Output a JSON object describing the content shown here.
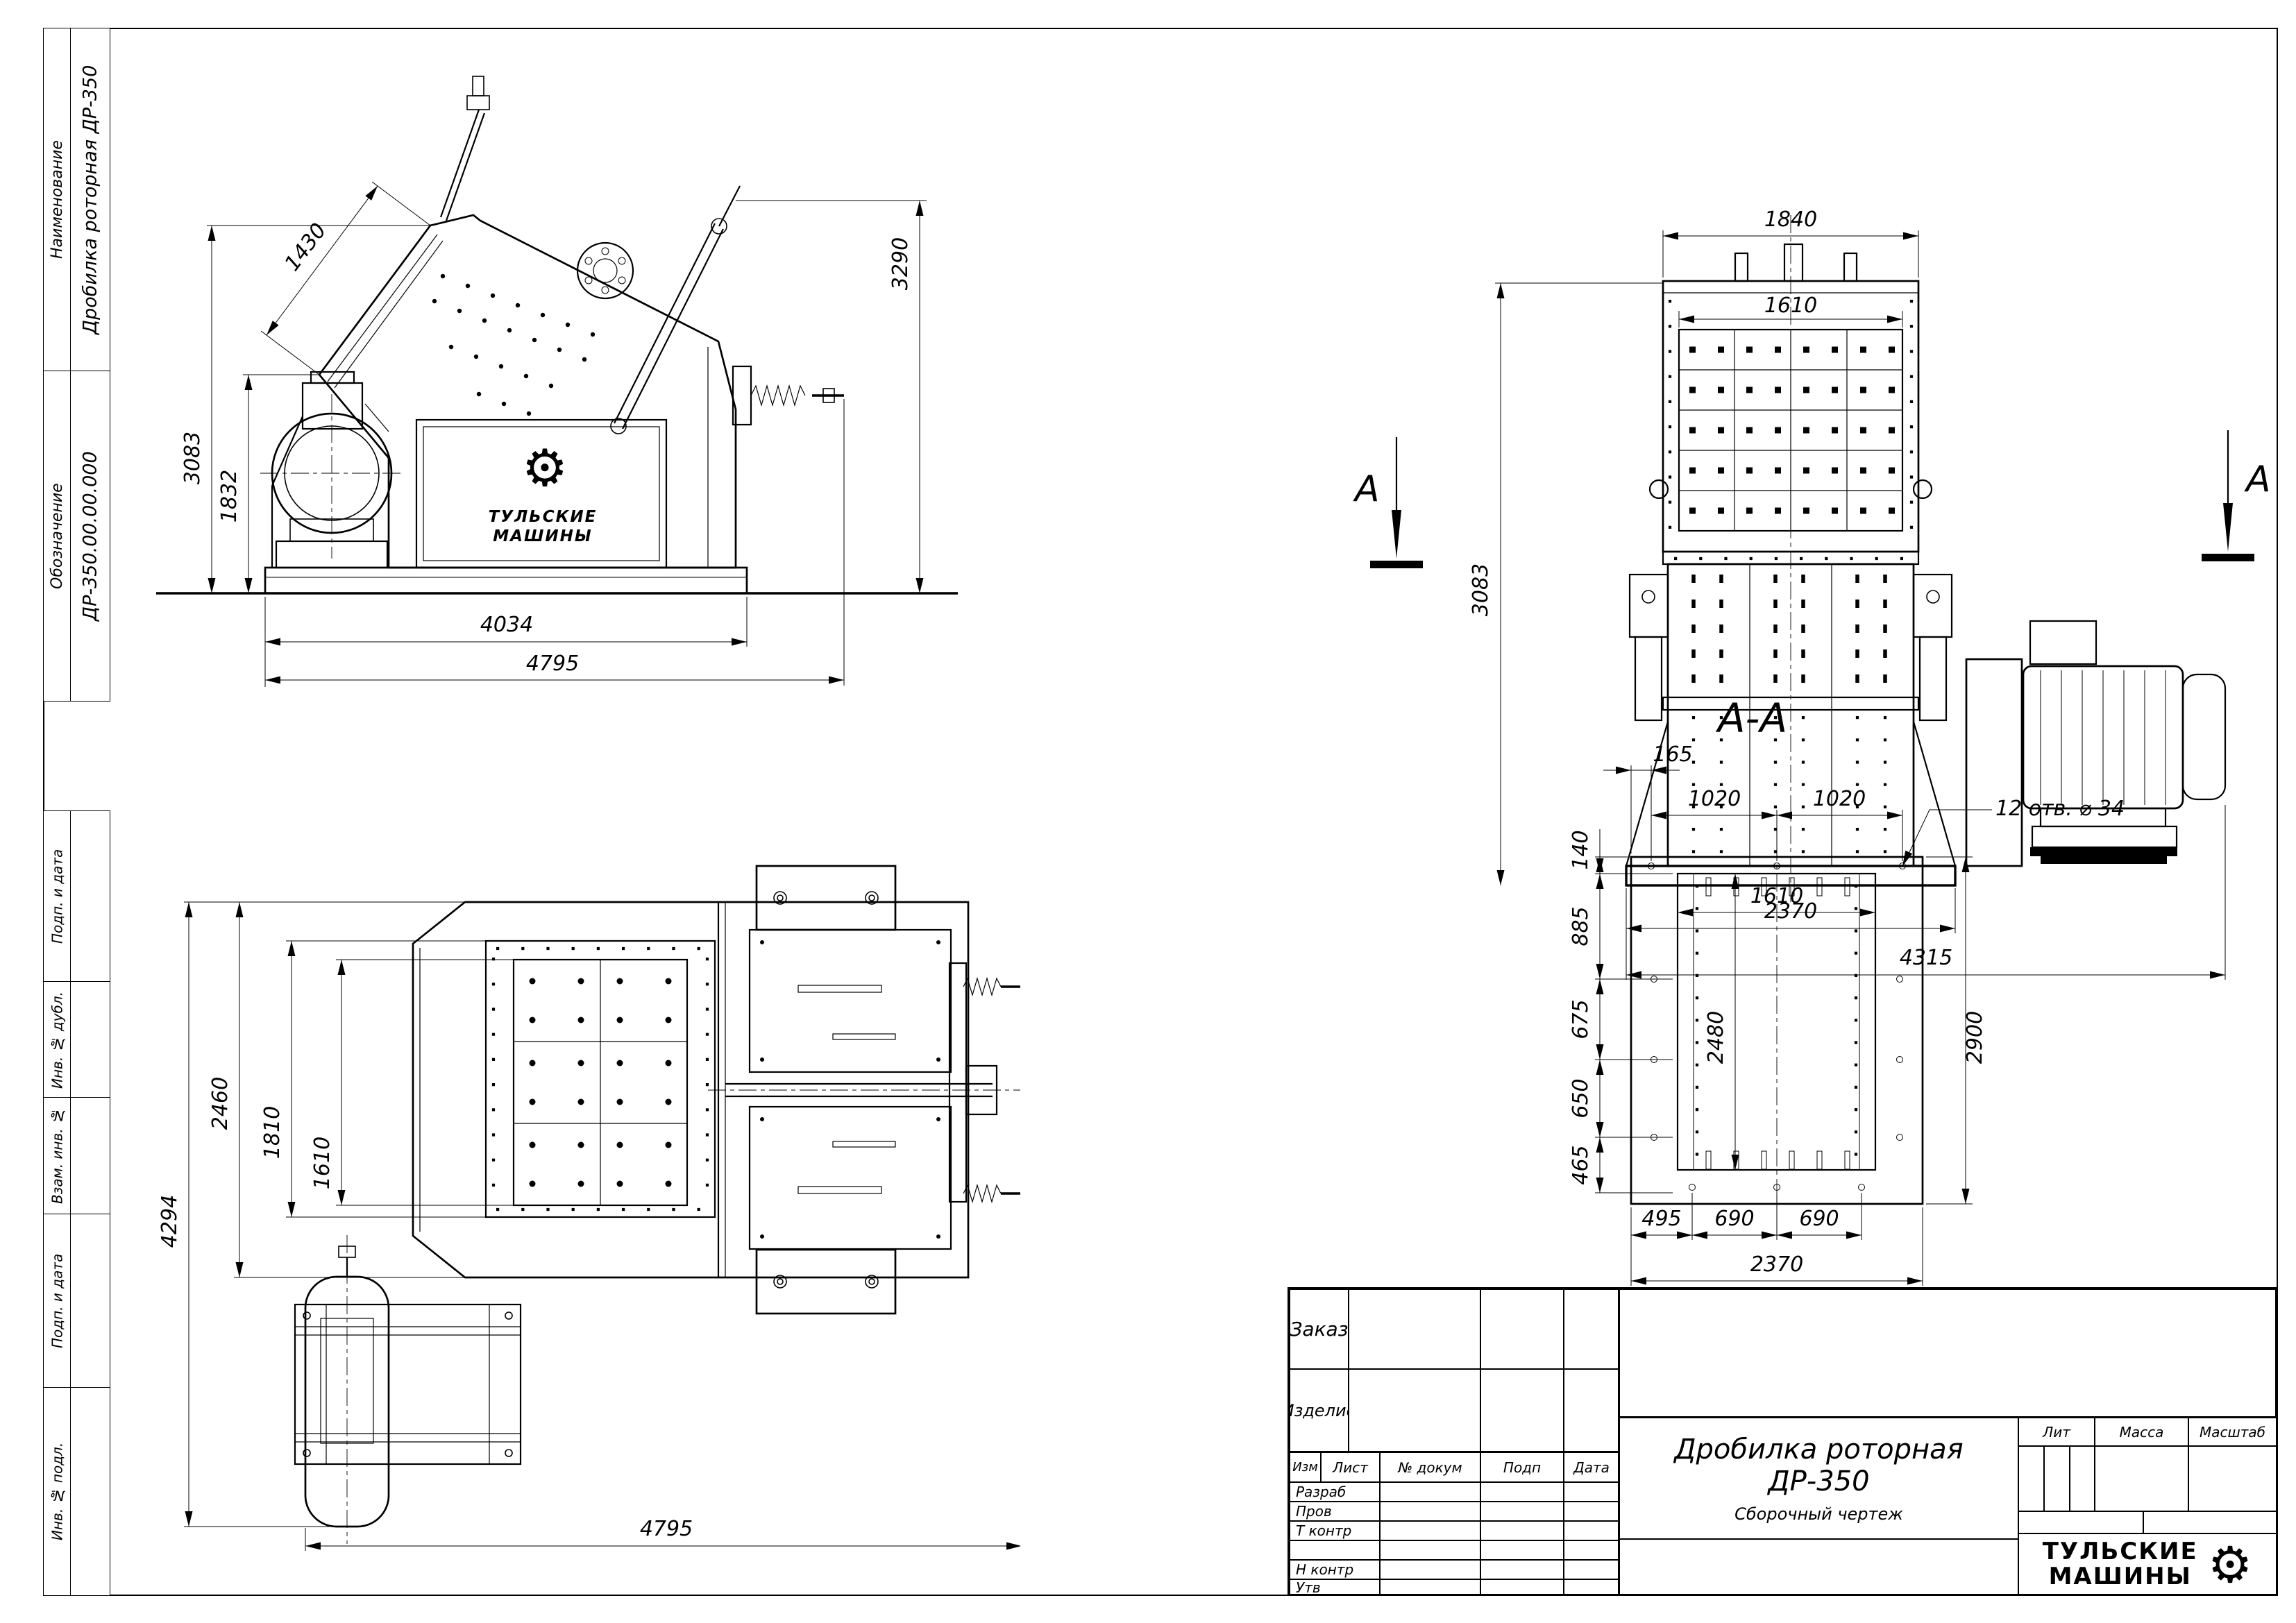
{
  "icons": {
    "gear": "⚙"
  },
  "left_panel": {
    "blocks": [
      {
        "label": "Наименование",
        "value": "Дробилка роторная ДР-350"
      },
      {
        "label": "Обозначение",
        "value": "ДР-350.00.00.000"
      }
    ],
    "lower_blocks": [
      "Подп. и дата",
      "Инв. № дубл.",
      "Взам. инв. №",
      "Подп. и дата",
      "Инв. № подл."
    ]
  },
  "side_view": {
    "dims": {
      "d1430": "1430",
      "d3083": "3083",
      "d1832": "1832",
      "d3290": "3290",
      "d4034": "4034",
      "d4795": "4795"
    },
    "logo": {
      "line1": "ТУЛЬСКИЕ",
      "line2": "МАШИНЫ"
    }
  },
  "front_view": {
    "dims": {
      "d1840": "1840",
      "d1610": "1610",
      "d3083": "3083",
      "d2370": "2370",
      "d4315": "4315"
    },
    "section_marks": {
      "left": "А",
      "right": "А"
    }
  },
  "plan_view": {
    "dims": {
      "d4294": "4294",
      "d2460": "2460",
      "d1810": "1810",
      "d1610": "1610",
      "d4795": "4795"
    }
  },
  "section_view": {
    "title": "А-А",
    "callout": "12 отв. ⌀ 34",
    "dims": {
      "d165": "165",
      "d140": "140",
      "d1020a": "1020",
      "d1020b": "1020",
      "d885": "885",
      "d1610": "1610",
      "d675": "675",
      "d2480": "2480",
      "d650": "650",
      "d465": "465",
      "d2900": "2900",
      "d495": "495",
      "d690a": "690",
      "d690b": "690",
      "d2370": "2370"
    }
  },
  "title_block": {
    "order_label": "Заказ",
    "product_label": "Изделие",
    "header": {
      "izm": "Изм",
      "list": "Лист",
      "doc": "№ докум",
      "podp": "Подп",
      "data": "Дата"
    },
    "rows": {
      "r1": "Разраб",
      "r2": "Пров",
      "r3": "Т контр",
      "r4": "",
      "r5": "Н контр",
      "r6": "Утв"
    },
    "doc_title": "Дробилка роторная ДР-350",
    "doc_subtitle": "Сборочный чертеж",
    "lit_label": "Лит",
    "mass_label": "Масса",
    "scale_label": "Масштаб",
    "logo": {
      "line1": "ТУЛЬСКИЕ",
      "line2": "МАШИНЫ"
    }
  }
}
